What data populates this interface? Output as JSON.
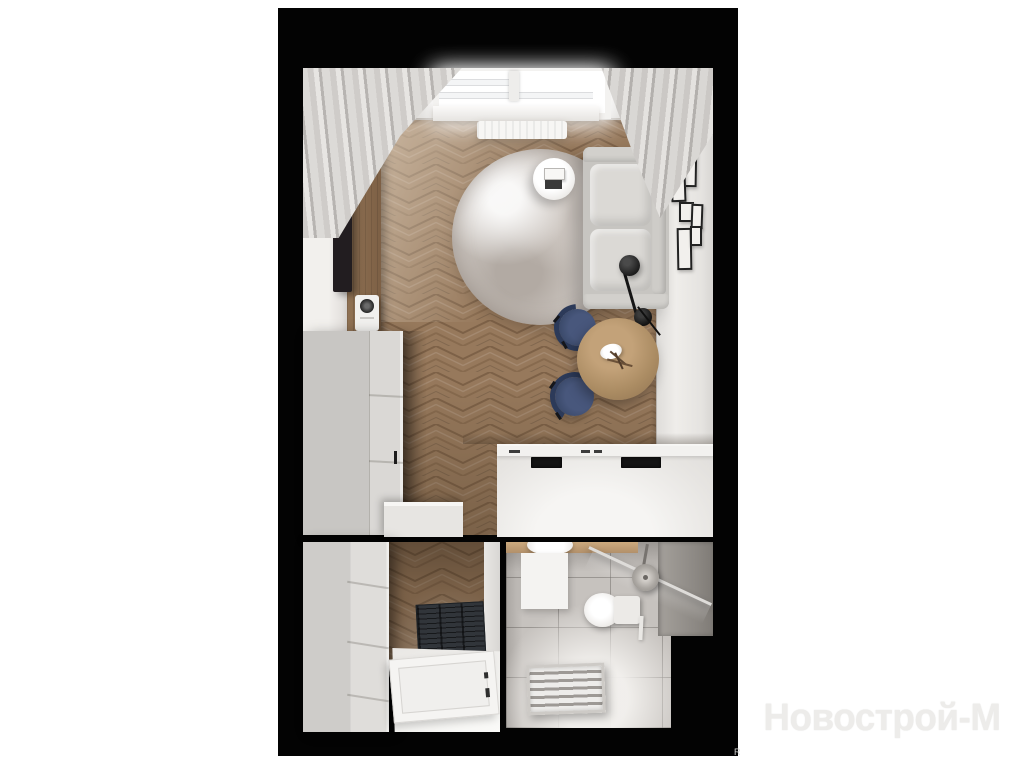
{
  "watermark": {
    "text": "Новострой-М",
    "corner_mark": "R"
  },
  "scene": {
    "title": "Studio apartment top-down 3D floor plan render",
    "rooms": [
      {
        "name": "Living room with kitchenette"
      },
      {
        "name": "Entry hallway"
      },
      {
        "name": "Bathroom"
      }
    ],
    "objects": [
      "window",
      "curtains",
      "radiator",
      "tv",
      "tv-media-panel",
      "intercom-socket",
      "wardrobe",
      "round-rug",
      "sofa",
      "side-table-with-books",
      "floor-lamp",
      "gallery-wall-frames",
      "dining-table",
      "dining-chairs",
      "kitchen-counter",
      "cooktop",
      "kitchen-sink",
      "entry-wardrobe",
      "doormat",
      "entrance-door",
      "bathroom-vanity",
      "washbasin",
      "bath-mat",
      "toilet",
      "shower-glass",
      "shower-head",
      "towel-radiator"
    ],
    "palette": {
      "backdrop": "#000000",
      "page": "#ffffff",
      "wood_floor": "#93755a",
      "walls": "#e8e6e3",
      "sofa": "#d6d4d0",
      "chairs_navy": "#3e4c6e",
      "table_wood": "#ab8c63",
      "bathroom_tile": "#c4c0bc"
    }
  }
}
